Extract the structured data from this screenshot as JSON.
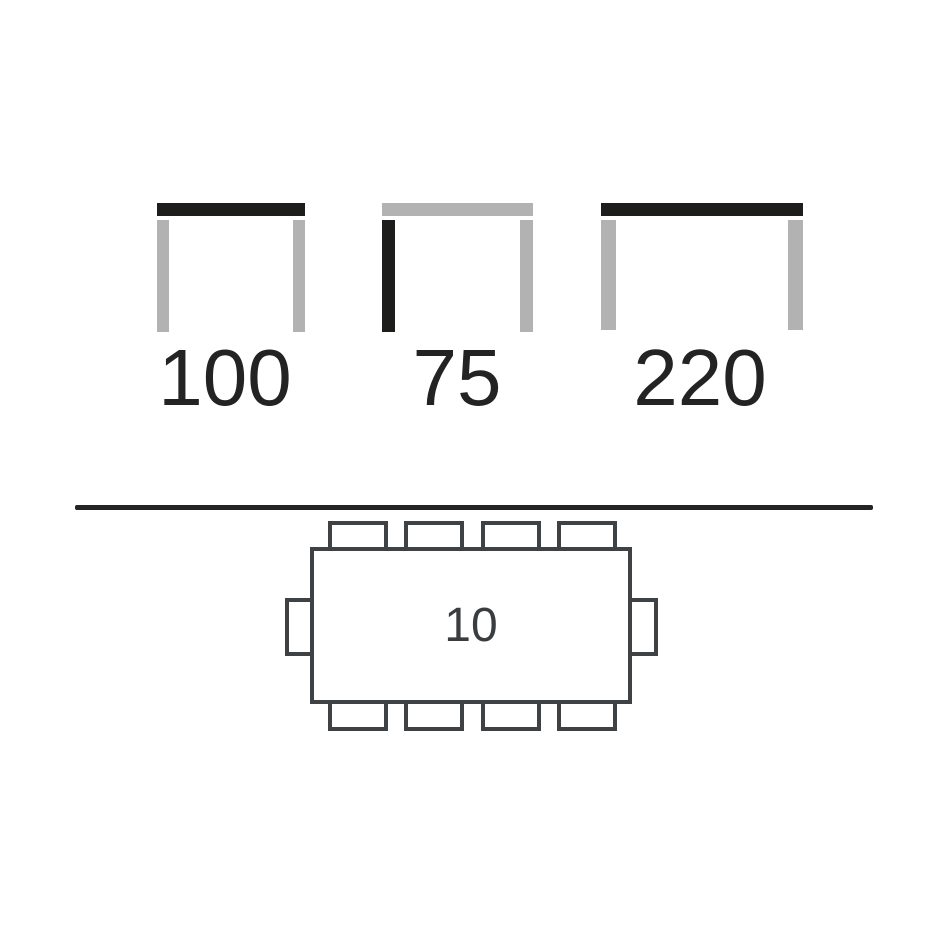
{
  "dimensions": {
    "items": [
      {
        "value": "100",
        "icon": "table-width-icon",
        "highlighted_part": "tabletop"
      },
      {
        "value": "75",
        "icon": "table-height-icon",
        "highlighted_part": "left_leg"
      },
      {
        "value": "220",
        "icon": "table-length-icon",
        "highlighted_part": "tabletop"
      }
    ]
  },
  "seating": {
    "capacity": "10",
    "chairs_top": 4,
    "chairs_bottom": 4,
    "chairs_left": 1,
    "chairs_right": 1
  },
  "colors": {
    "background": "#ffffff",
    "highlight_dark": "#1d1d1b",
    "muted_gray": "#b2b2b2",
    "outline": "#3f4245",
    "divider": "#242424",
    "label_text": "#232323"
  }
}
